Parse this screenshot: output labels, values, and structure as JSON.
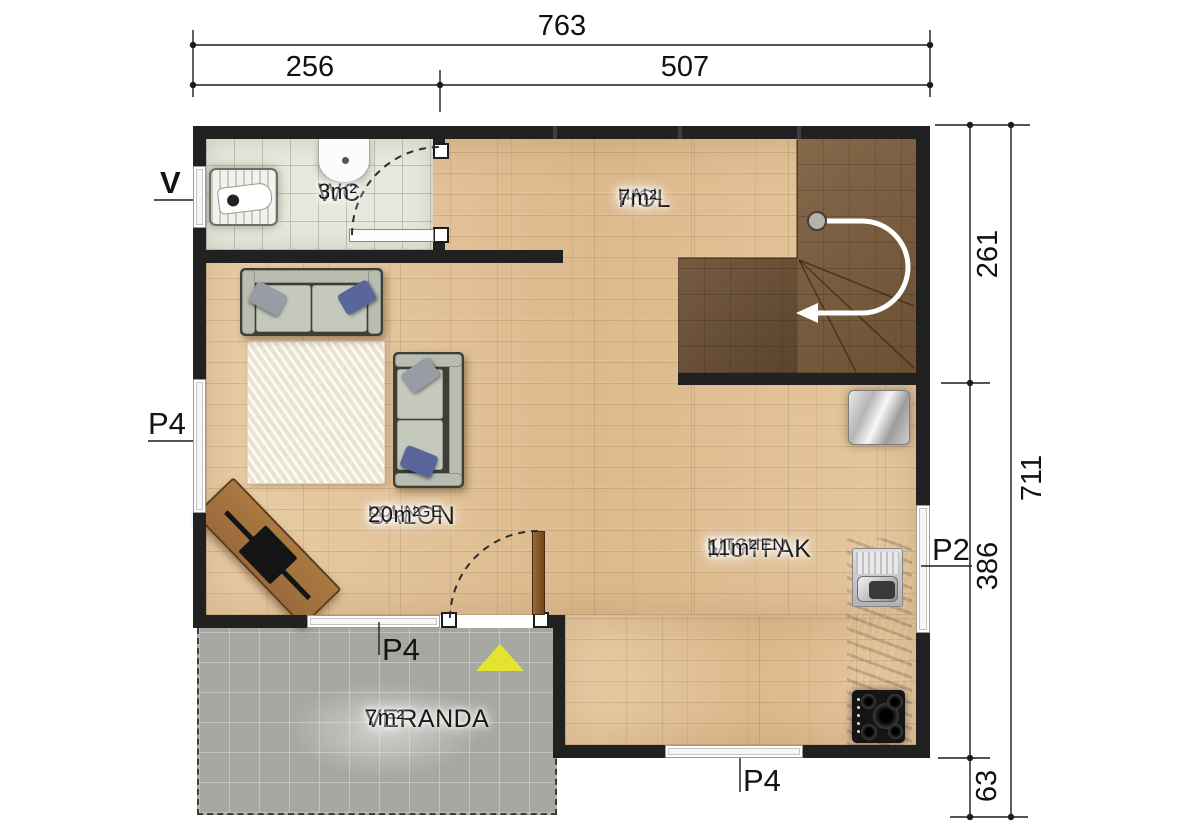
{
  "plan": {
    "rooms": {
      "wc": {
        "name": "WC",
        "area": "3m²"
      },
      "hol": {
        "name": "HOL",
        "sub": "HALL",
        "area": "7m²"
      },
      "salon": {
        "name": "SALON",
        "sub": "LOUNGE",
        "area": "20m²"
      },
      "mutfak": {
        "name": "MUTFAK",
        "sub": "KITCHEN",
        "area": "11m²"
      },
      "veranda": {
        "name": "VERANDA",
        "area": "7m²"
      }
    },
    "dimensions": {
      "top_total": "763",
      "top_left": "256",
      "top_right": "507",
      "right_upper": "261",
      "right_middle": "386",
      "right_lower": "63",
      "right_total": "711"
    },
    "markers": {
      "window_left": "V",
      "door_left": "P4",
      "door_veranda": "P4",
      "door_kitchen": "P4",
      "window_right": "P2"
    },
    "palette": {
      "wall": "#212121",
      "wood_floor": "#e3c298",
      "stairs_wood": "#7d5d3d",
      "wc_tile": "#e7e7dc",
      "veranda_tile": "#a7a7a2",
      "counter": "#6e5539",
      "entrance_triangle": "#e4e430",
      "pillow_blue": "#58669b",
      "sofa": "#b9bdb0"
    }
  }
}
